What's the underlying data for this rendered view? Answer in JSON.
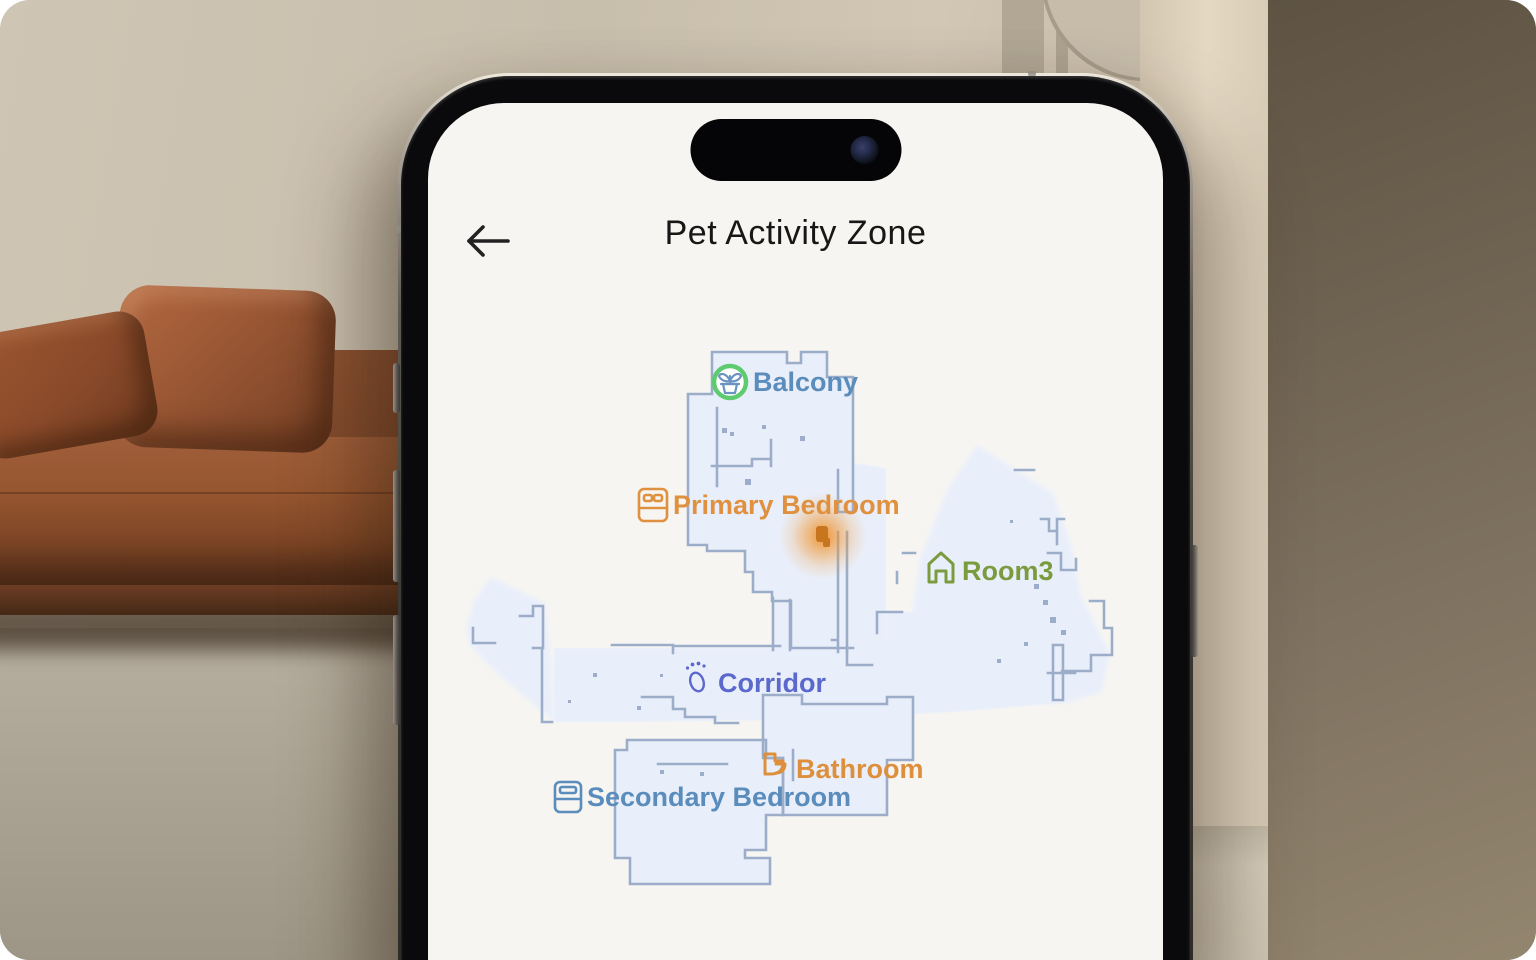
{
  "screen": {
    "title": "Pet Activity Zone"
  },
  "map": {
    "floor_fill": "#e9effa",
    "wall_color": "#9cadc9",
    "hotspot_color": "#f0922b",
    "hotspot_core_color": "#c8751f",
    "rooms": [
      {
        "label": "Balcony",
        "color": "#5a8cbc",
        "icon": "plant-pot-icon",
        "ring_color": "#5ecb70",
        "glyph_color": "#6b93c2"
      },
      {
        "label": "Primary Bedroom",
        "color": "#e0913f",
        "icon": "double-bed-icon"
      },
      {
        "label": "Room3",
        "color": "#7a9b3e",
        "icon": "house-icon"
      },
      {
        "label": "Corridor",
        "color": "#5b68cc",
        "icon": "footprint-icon"
      },
      {
        "label": "Bathroom",
        "color": "#dd8f3c",
        "icon": "toilet-icon"
      },
      {
        "label": "Secondary Bedroom",
        "color": "#5a8cbc",
        "icon": "single-bed-icon"
      }
    ]
  }
}
